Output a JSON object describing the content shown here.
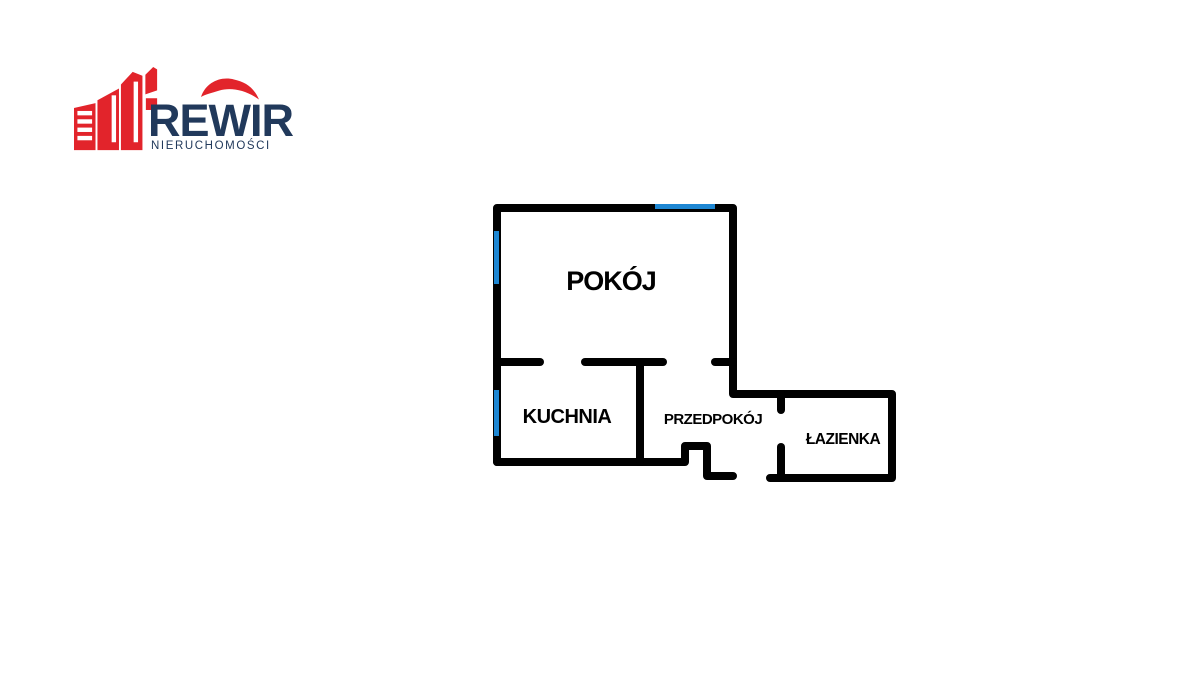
{
  "page": {
    "background_color": "#ffffff"
  },
  "logo": {
    "brand": "REWIR",
    "tagline": "NIERUCHOMOŚCI",
    "colors": {
      "red": "#E2242B",
      "navy": "#21395B"
    }
  },
  "floorplan": {
    "colors": {
      "wall": "#010101",
      "window": "#1E87D3"
    },
    "rooms": [
      {
        "id": "pokoj",
        "label": "POKÓJ"
      },
      {
        "id": "kuchnia",
        "label": "KUCHNIA"
      },
      {
        "id": "przedpokoj",
        "label": "PRZEDPOKÓJ"
      },
      {
        "id": "lazienka",
        "label": "ŁAZIENKA"
      }
    ],
    "window_markers": 3
  }
}
